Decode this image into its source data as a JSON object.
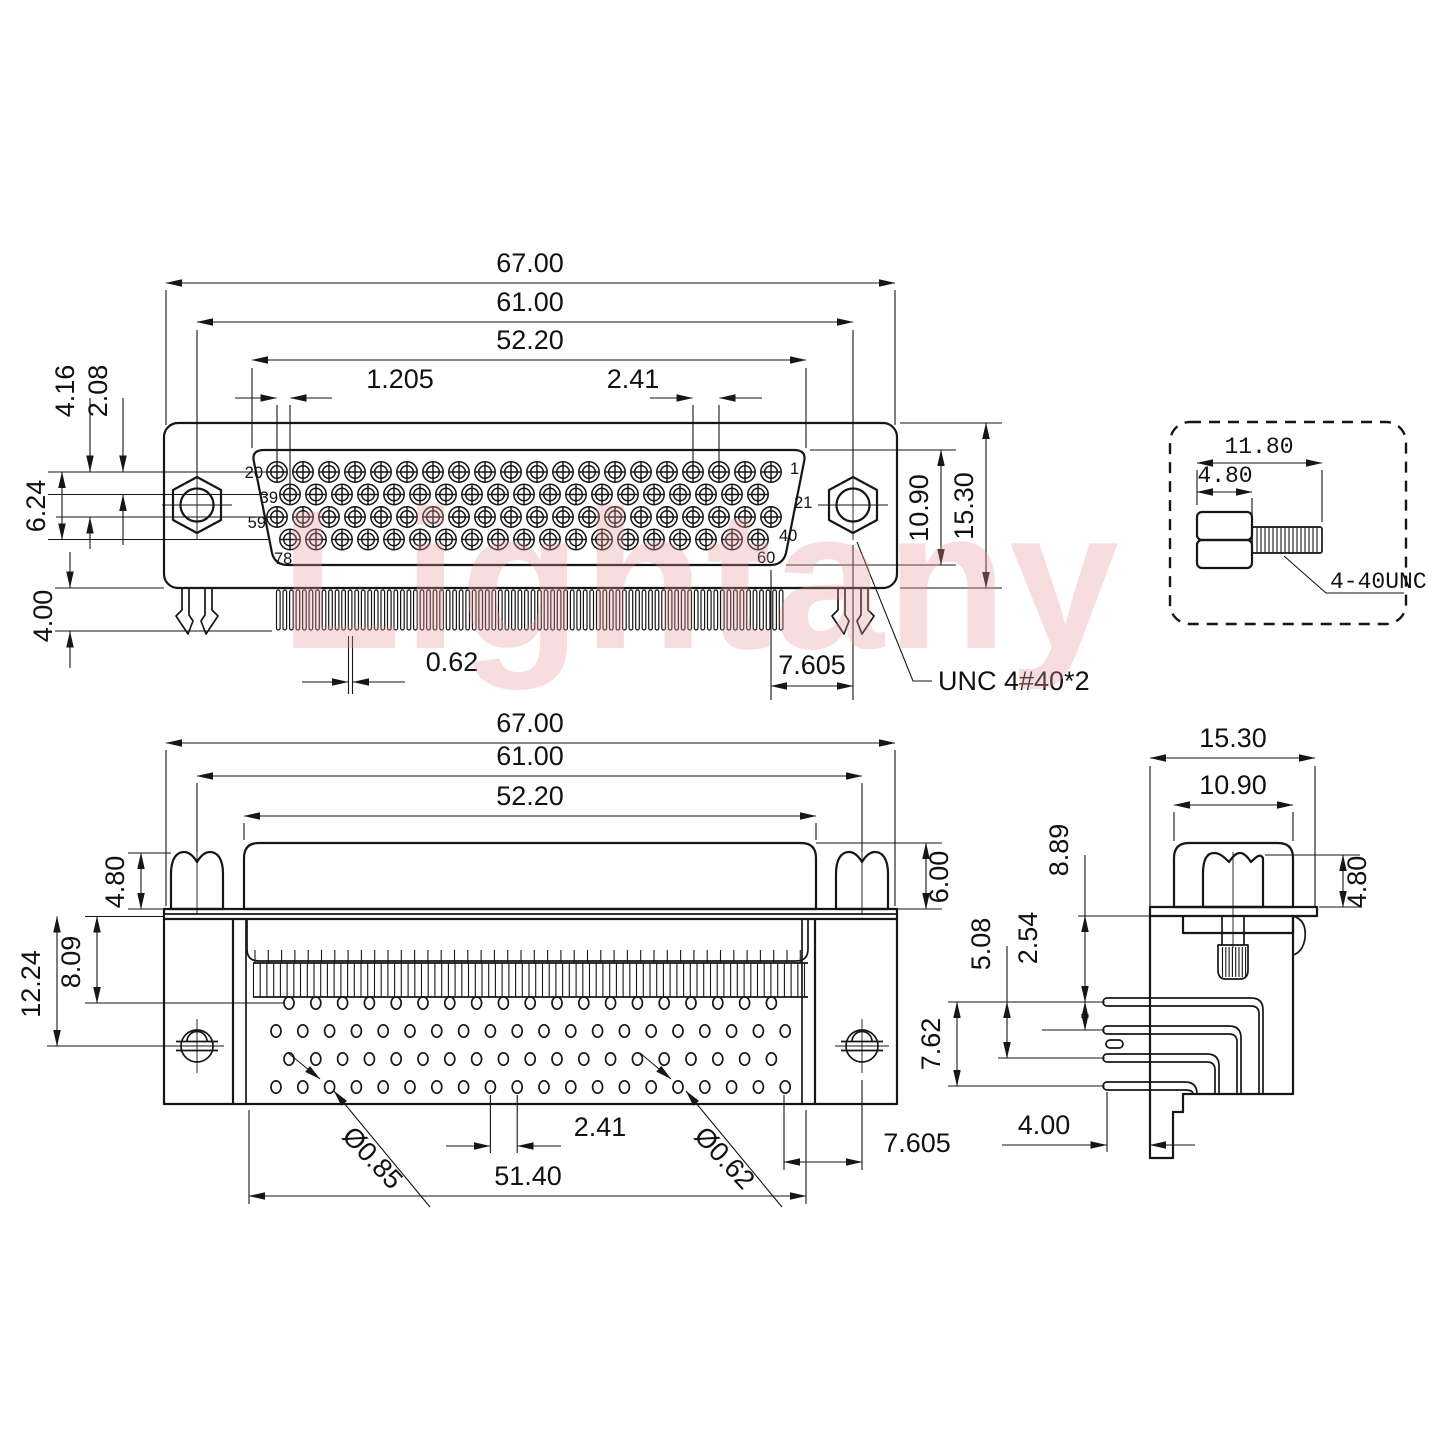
{
  "watermark": {
    "text": "Lightany"
  },
  "front": {
    "d67": "67.00",
    "d61": "61.00",
    "d522": "52.20",
    "d1205": "1.205",
    "d241": "2.41",
    "d416": "4.16",
    "d208": "2.08",
    "d624": "6.24",
    "d400": "4.00",
    "d1090": "10.90",
    "d1530": "15.30",
    "d062": "0.62",
    "d7605": "7.605",
    "unc": "UNC 4#40*2",
    "pins_per_row": [
      20,
      19,
      20,
      19
    ],
    "pins": {
      "p20": "20",
      "p1": "1",
      "p39": "39",
      "p21": "21",
      "p59": "59",
      "p40": "40",
      "p78": "78",
      "p60": "60"
    }
  },
  "detail": {
    "d1180": "11.80",
    "d480": "4.80",
    "thread": "4-40UNC"
  },
  "rear": {
    "d67": "67.00",
    "d61": "61.00",
    "d522": "52.20",
    "d480": "4.80",
    "d600": "6.00",
    "d809": "8.09",
    "d1224": "12.24",
    "d085": "Ø0.85",
    "d241": "2.41",
    "d062": "Ø0.62",
    "d5140": "51.40",
    "d7605": "7.605",
    "holes_per_row": [
      19,
      20,
      19,
      20
    ]
  },
  "side": {
    "d1530": "15.30",
    "d1090": "10.90",
    "d480": "4.80",
    "d889": "8.89",
    "d508": "5.08",
    "d254": "2.54",
    "d762": "7.62",
    "d400": "4.00"
  }
}
